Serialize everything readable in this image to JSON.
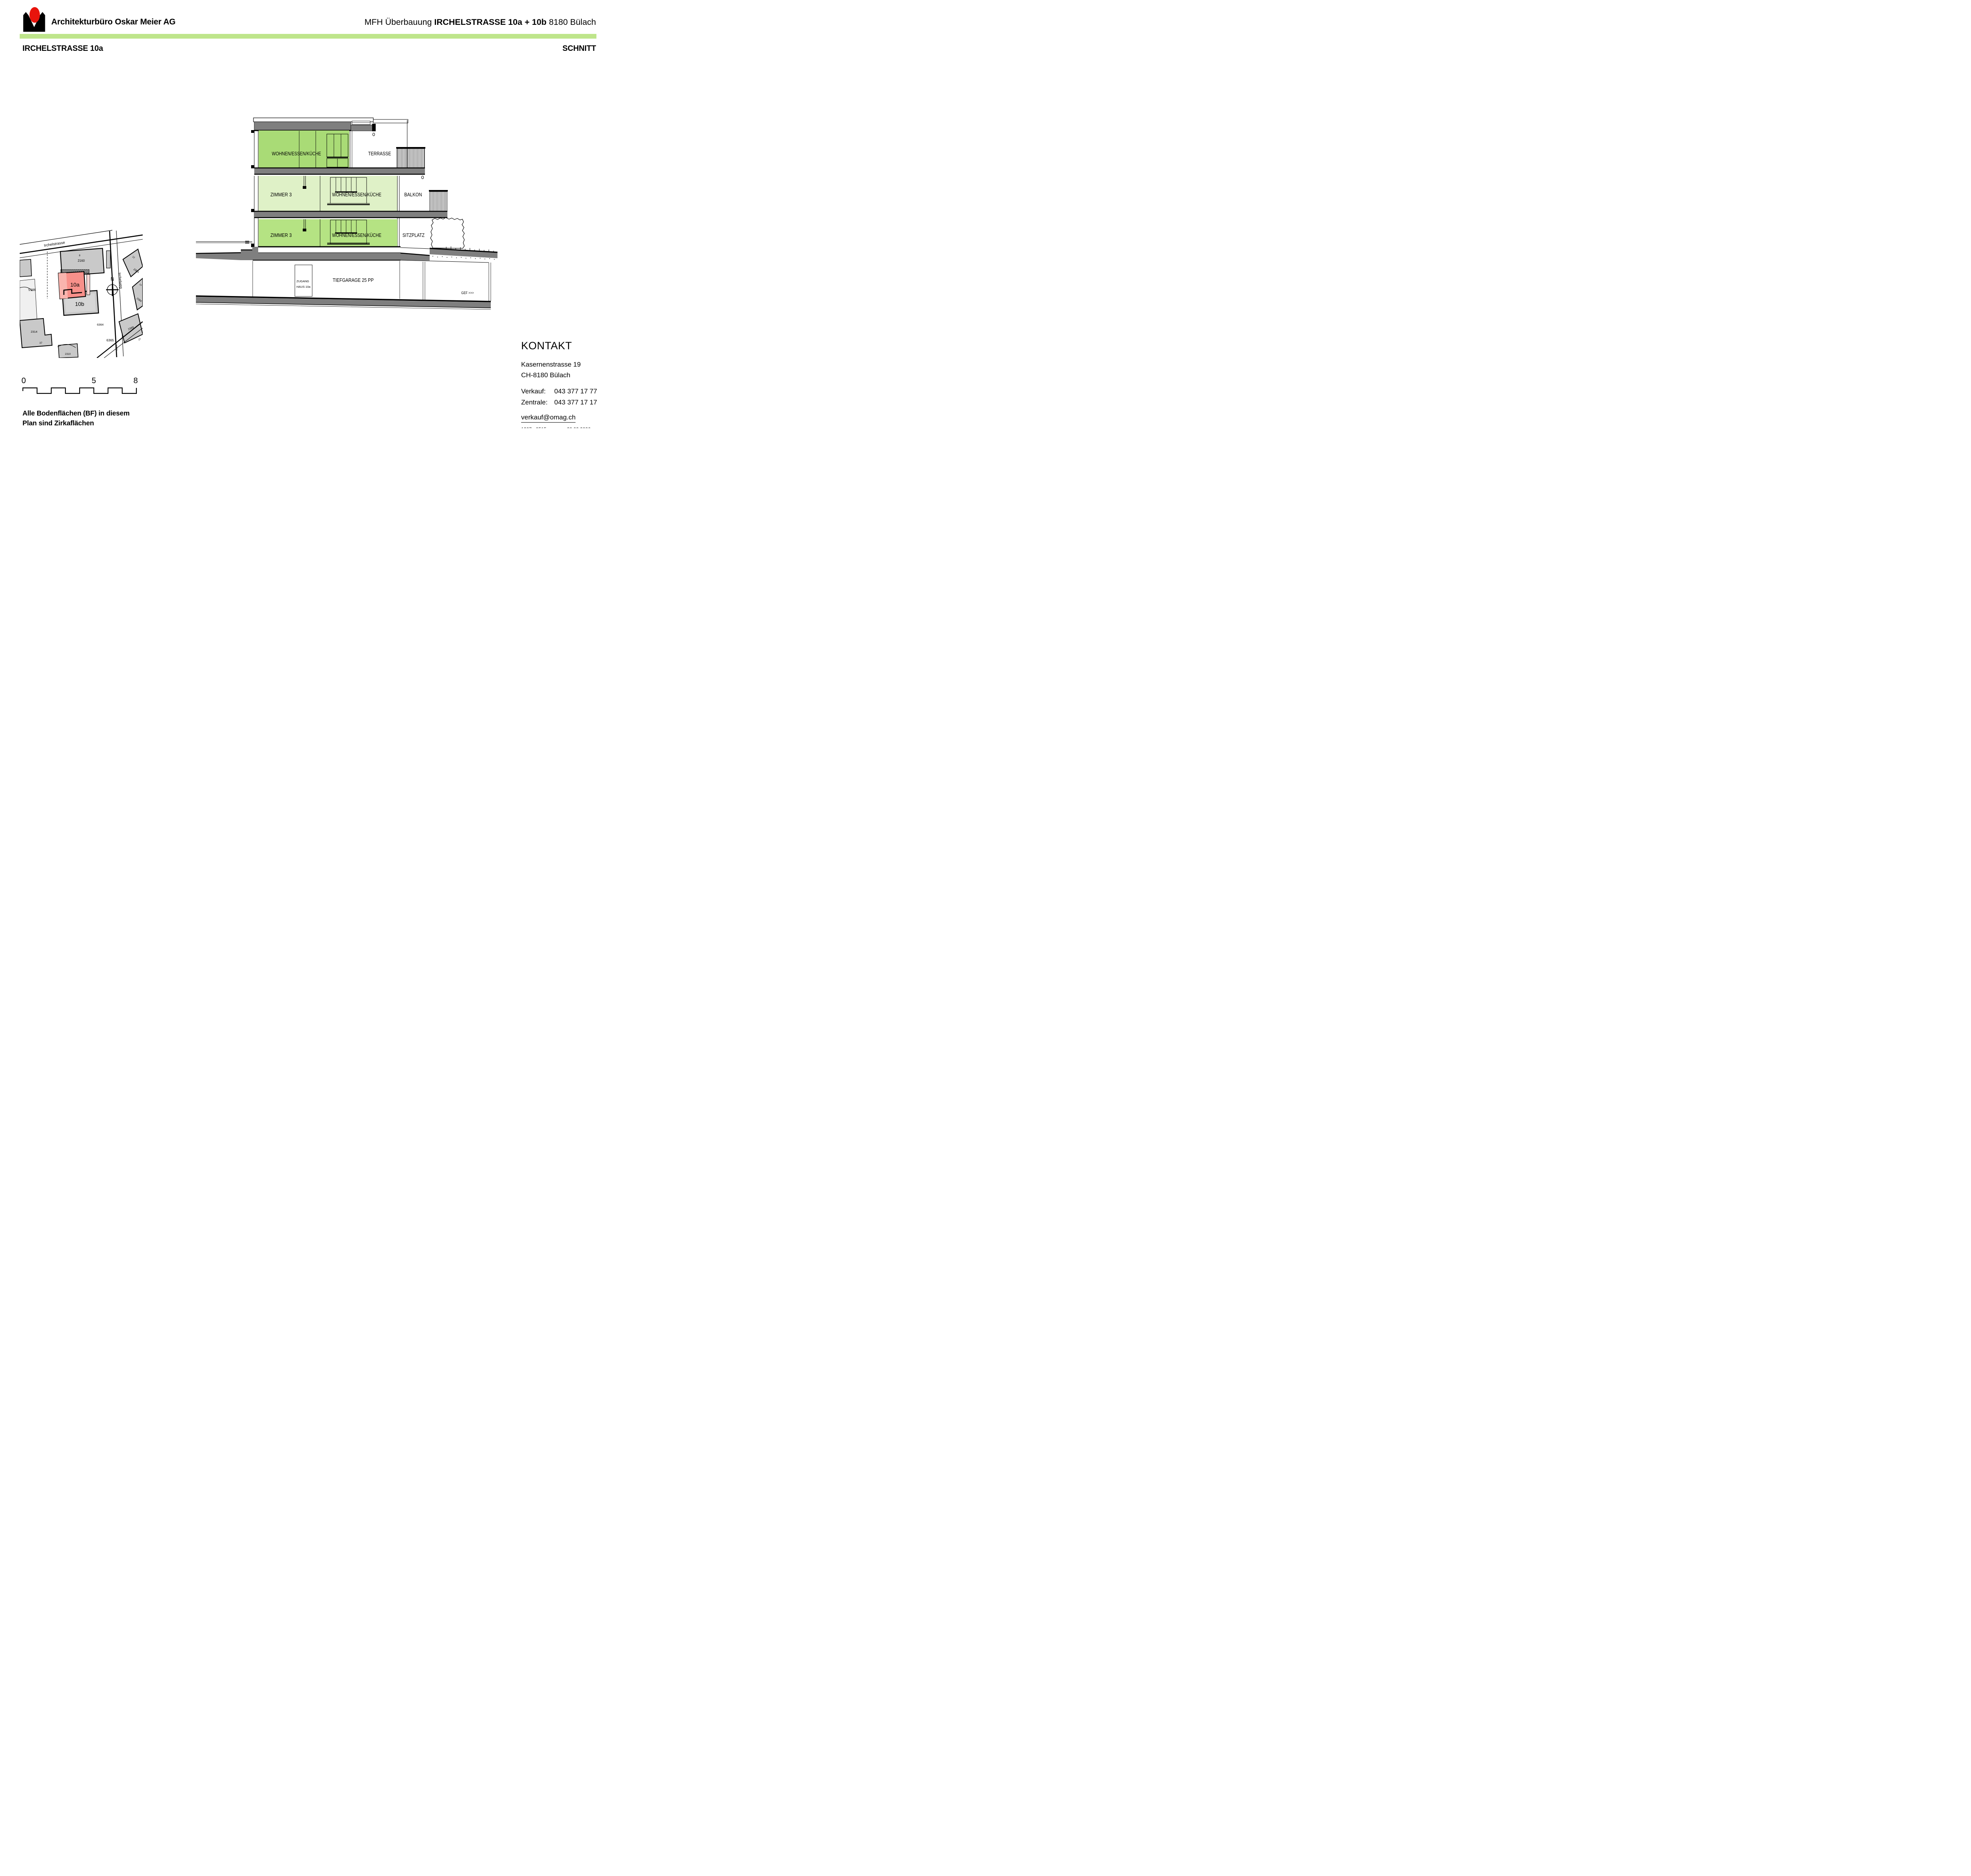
{
  "header": {
    "company": "Architekturbüro Oskar Meier AG",
    "project_prefix": "MFH Überbauung",
    "project_name": "IRCHELSTRASSE 10a + 10b",
    "project_city": "8180 Bülach"
  },
  "sheet": {
    "title_left": "IRCHELSTRASSE 10a",
    "title_right": "SCHNITT"
  },
  "section": {
    "attic": {
      "room": "WOHNEN/ESSEN/KÜCHE",
      "outdoor": "TERRASSE"
    },
    "upper": {
      "room1": "ZIMMER 3",
      "room2": "WOHNEN/ESSEN/KÜCHE",
      "outdoor": "BALKON"
    },
    "ground": {
      "room1": "ZIMMER 3",
      "room2": "WOHNEN/ESSEN/KÜCHE",
      "outdoor": "SITZPLATZ"
    },
    "basement": {
      "garage": "TIEFGARAGE 25 PP",
      "access_line1": "ZUGANG",
      "access_line2": "HAUS 10a",
      "slope": "GEF >>>"
    }
  },
  "siteplan": {
    "street": "Irchelstrasse",
    "street2": "Irchelweg",
    "north": "N",
    "building_a": "10a",
    "building_b": "10b",
    "parcels": {
      "p8": "8",
      "p2160": "2160",
      "p12": "12",
      "p2384a": "2384",
      "p14": "14",
      "p2384b": "2384",
      "p5166": "5166",
      "p6364": "6364",
      "p6365": "6365",
      "p2389": "2389",
      "p27": "27",
      "p2314": "2314",
      "p37": "37",
      "p2310": "2310",
      "p5132": "5132"
    }
  },
  "scalebar": {
    "n0": "0",
    "n5": "5",
    "n8": "8"
  },
  "note": {
    "line1": "Alle Bodenflächen (BF) in diesem",
    "line2": "Plan sind Zirkaflächen"
  },
  "kontakt": {
    "title": "KONTAKT",
    "address1": "Kasernenstrasse 19",
    "address2": "CH-8180 Bülach",
    "phone1_label": "Verkauf:",
    "phone1": "043 377 17 77",
    "phone2_label": "Zentrale:",
    "phone2": "043 377 17 17",
    "email": "verkauf@omag.ch",
    "doc_number": "1207 - 9515",
    "doc_date": "20.02.2026"
  },
  "colors": {
    "band_green": "#bee58b",
    "attic_green": "#a9db76",
    "upper_green": "#dff1c7",
    "ground_green": "#b5e383",
    "slab_gray": "#7f7f7f",
    "building_red": "#f8908a",
    "building_red_light": "#f9b4ae",
    "map_gray": "#c9c9c9"
  }
}
